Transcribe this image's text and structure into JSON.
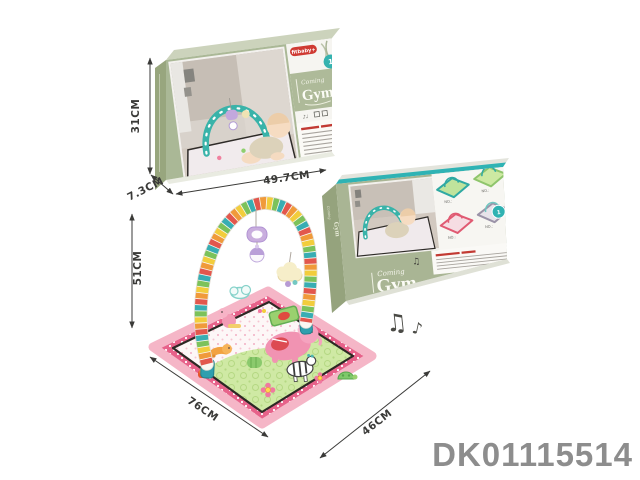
{
  "product_code": "DK01115514",
  "colors": {
    "box_front": "#aab896",
    "box_side": "#98a67e",
    "box_top": "#ccd3bc",
    "teal_accent": "#2fb3b4",
    "brand_red": "#cf3a33",
    "mat_pink_band": "#e7628a",
    "mat_green": "#cfe9a4",
    "code_gray": "#8d8d8d"
  },
  "front_box": {
    "brand": "fitbaby+",
    "badge": "1",
    "script_top": "Coming",
    "title": "Gym",
    "dim_height": "31CM",
    "dim_depth": "7.3CM",
    "dim_width": "49.7CM"
  },
  "side_box": {
    "script_top": "Coming",
    "title": "Gym",
    "badge": "1",
    "no_label": "NO.:",
    "notes": "♫"
  },
  "gym_product": {
    "dim_height": "51CM",
    "dim_width": "76CM",
    "dim_depth": "46CM"
  },
  "music_notes": {
    "beamed": "♫",
    "single": "♪"
  }
}
